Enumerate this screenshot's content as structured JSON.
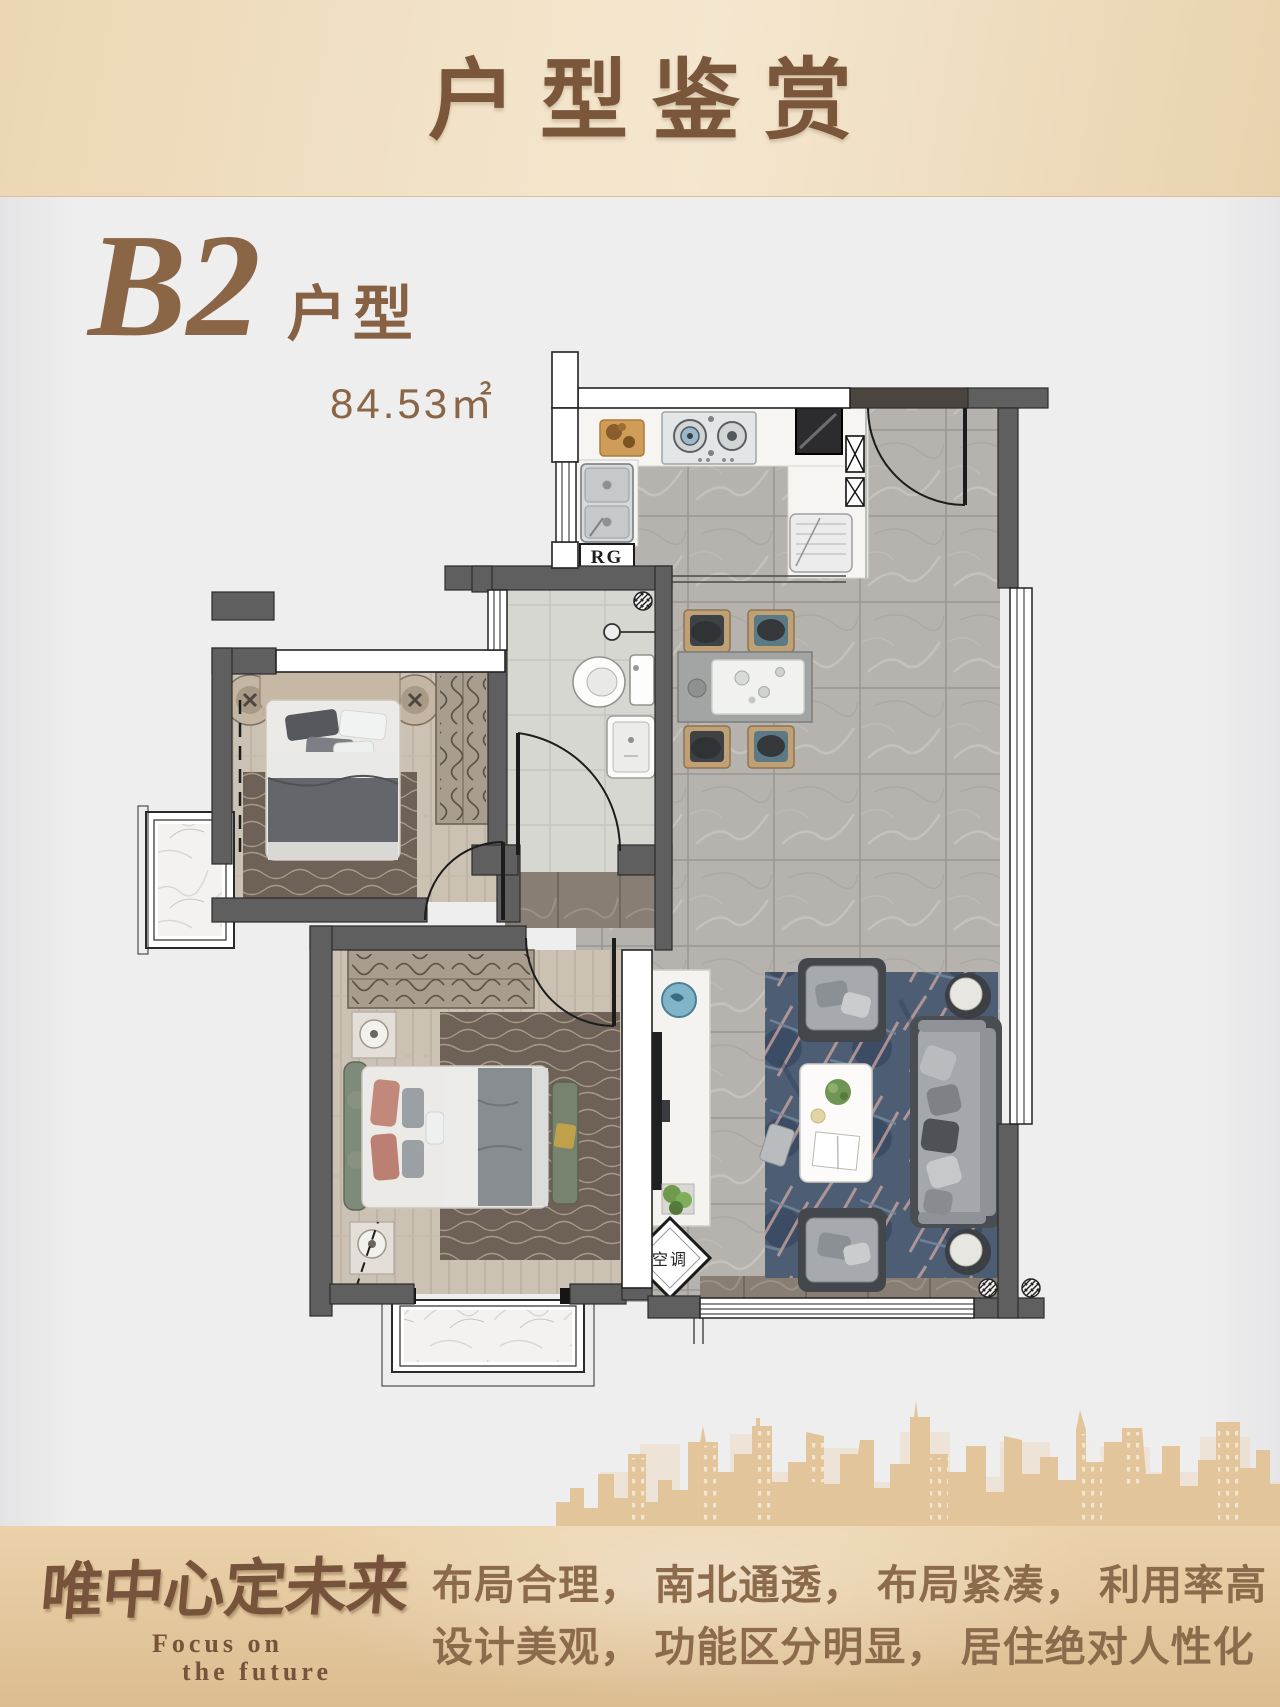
{
  "header": {
    "title": "户型鉴赏"
  },
  "unit": {
    "name": "B2",
    "type_suffix": "户型",
    "area": "84.53㎡"
  },
  "plan": {
    "rg_label": "RG",
    "ac_label": "空调"
  },
  "footer": {
    "slogan_cn": "唯中心定未来",
    "slogan_en_line1": "Focus on",
    "slogan_en_line2": "the future",
    "desc_line1": "布局合理， 南北通透， 布局紧凑， 利用率高",
    "desc_line2": "设计美观， 功能区分明显， 居住绝对人性化"
  },
  "colors": {
    "header_text": "#7a573b",
    "accent_brown": "#8a6546",
    "footer_text": "#8c6b4c",
    "skyline_gold": "#e3c59c",
    "wall_gray": "#5f5f60"
  }
}
